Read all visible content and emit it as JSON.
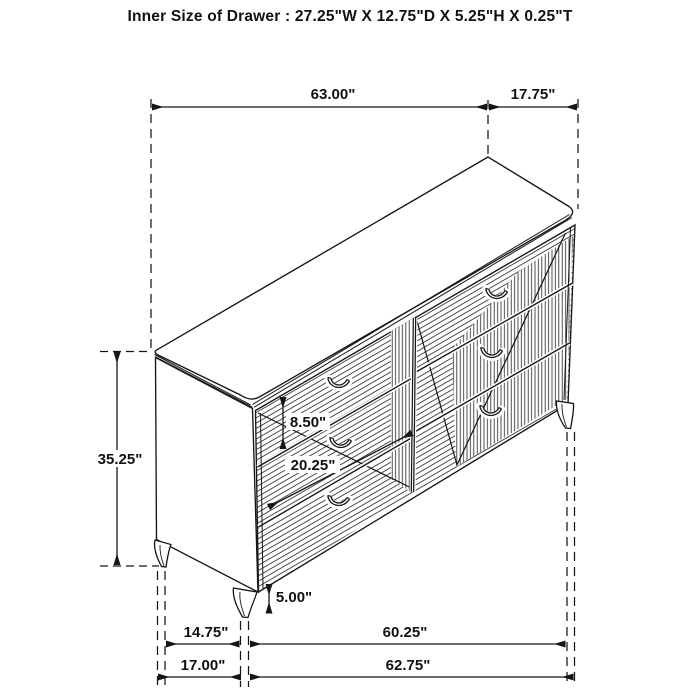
{
  "title": "Inner Size of Drawer : 27.25\"W X 12.75\"D X 5.25\"H X 0.25\"T",
  "figure": {
    "description": "Perspective line drawing of a six-drawer dresser with chevron-patterned drawer fronts and tapered legs",
    "ink_color": "#161616",
    "background_color": "#ffffff"
  },
  "dims": {
    "top_width": "63.00\"",
    "top_depth": "17.75\"",
    "overall_height": "35.25\"",
    "drawer_front_height": "8.50\"",
    "drawer_front_width": "20.25\"",
    "leg_height": "5.00\"",
    "leg_span_depth": "14.75\"",
    "leg_span_width": "60.25\"",
    "base_depth": "17.00\"",
    "base_width": "62.75\""
  }
}
